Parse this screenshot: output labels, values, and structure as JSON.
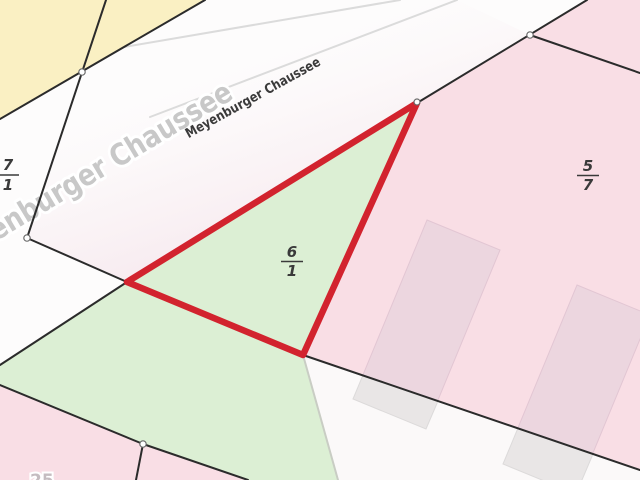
{
  "map": {
    "street": {
      "name_large": "Meyenburger Chaussee",
      "name_small": "Meyenburger Chaussee"
    },
    "parcels": {
      "p71": {
        "label": "7/1",
        "numerator": "7",
        "denominator": "1"
      },
      "p61": {
        "label": "6/1",
        "numerator": "6",
        "denominator": "1",
        "highlighted": true
      },
      "p57": {
        "label": "5/7",
        "numerator": "5",
        "denominator": "7"
      }
    },
    "partial_house_number": "25",
    "colors": {
      "base": "#fdfcfc",
      "yellow": "#faf0c3",
      "pink": "#f9dee5",
      "green": "#dcefd4",
      "building_pink": "#ecd6df",
      "building_grey": "#e9e6e6",
      "white_lower": "#fbf9f9",
      "highlight_red": "#d2232e",
      "boundary": "#2b2b2b",
      "road_edge": "#dbdbdb",
      "green_edge": "#c9cdc4",
      "label": "#3a3a3a",
      "street_large": "#c8c8c8"
    }
  }
}
